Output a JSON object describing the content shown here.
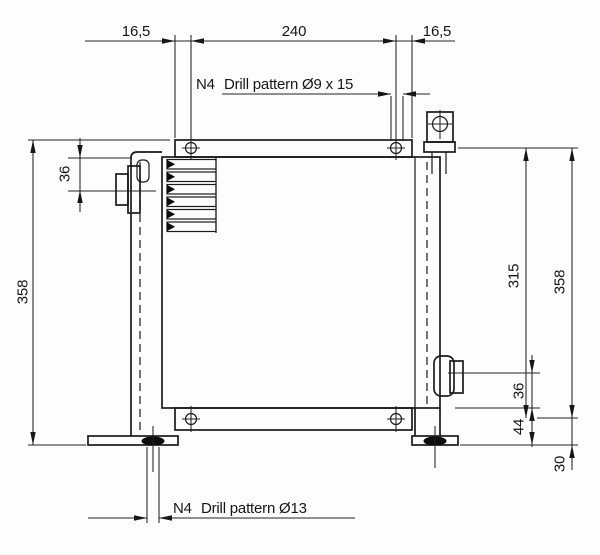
{
  "callouts": {
    "top": {
      "prefix": "N4",
      "label": "Drill pattern Ø9 x 15"
    },
    "bottom": {
      "prefix": "N4",
      "label": "Drill pattern Ø13"
    }
  },
  "dimensions": {
    "top_left_edge_to_hole": "16,5",
    "hole_spacing_horizontal": "240",
    "top_right_edge_to_hole": "16,5",
    "top_to_left_port_center": "36",
    "overall_height_left": "358",
    "hole_spacing_vertical": "315",
    "overall_height_right": "358",
    "right_port_to_body_bottom": "36",
    "body_bottom_to_foot_bottom": "44",
    "hole_center_to_foot_bottom": "30"
  }
}
